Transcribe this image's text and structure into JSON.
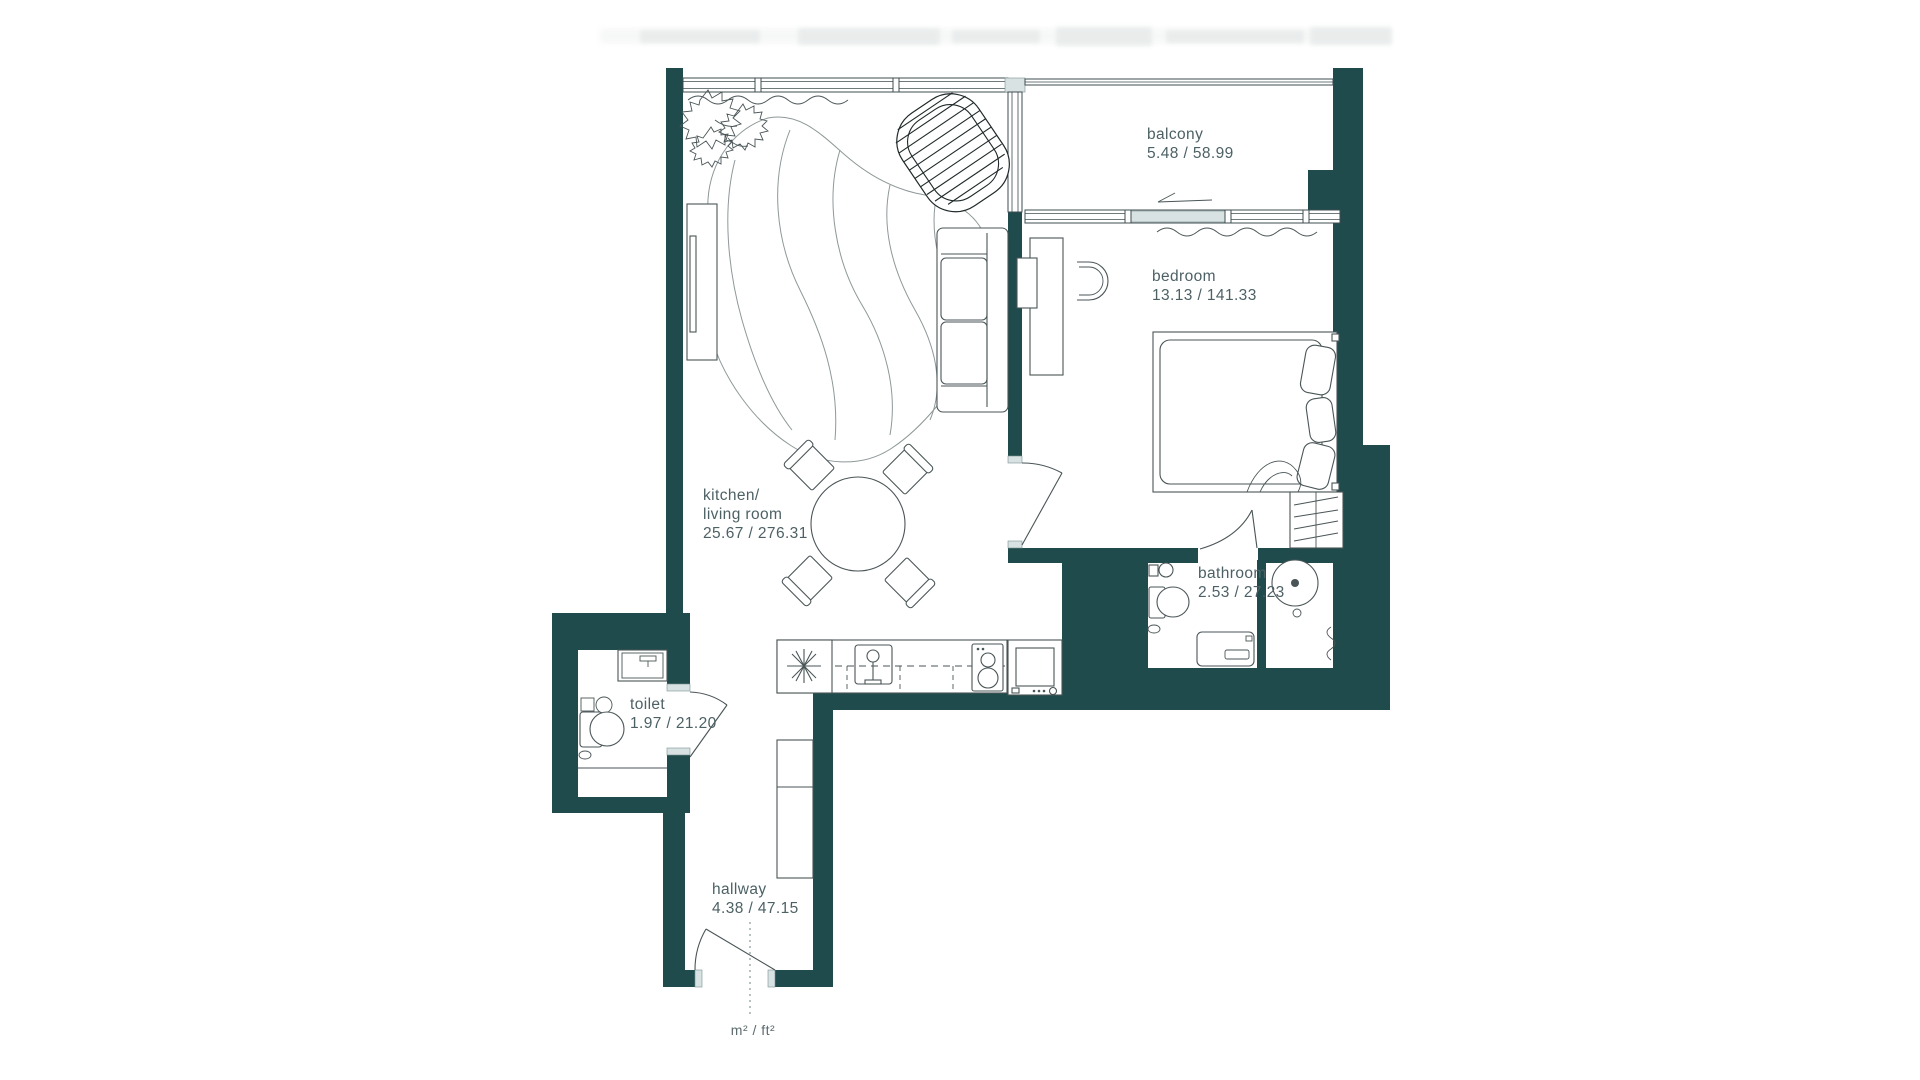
{
  "colors": {
    "wall": "#1f4b4c",
    "furniture_line": "#4a5557",
    "label_text": "#4d6165",
    "window_fill": "#d9e2e2"
  },
  "rooms": {
    "balcony": {
      "label": "balcony",
      "area": "5.48 / 58.99"
    },
    "bedroom": {
      "label": "bedroom",
      "area": "13.13 / 141.33"
    },
    "kitchen_living": {
      "label_line1": "kitchen/",
      "label_line2": "living room",
      "area": "25.67 / 276.31"
    },
    "bathroom": {
      "label": "bathroom",
      "area": "2.53 / 27.23"
    },
    "toilet": {
      "label": "toilet",
      "area": "1.97 / 21.20"
    },
    "hallway": {
      "label": "hallway",
      "area": "4.38 / 47.15"
    }
  },
  "legend": {
    "units": "m² / ft²"
  }
}
